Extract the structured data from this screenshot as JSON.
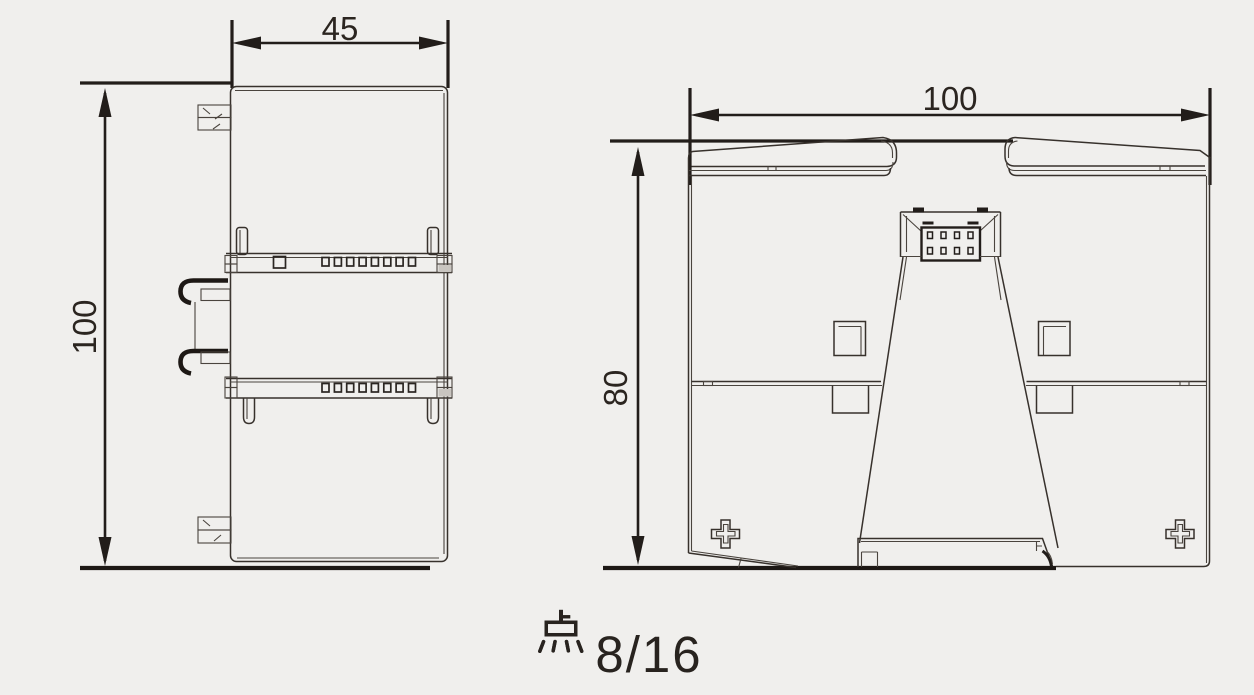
{
  "caption": "8点/16点",
  "side_view": {
    "label": "module side view",
    "width_dim": "45",
    "height_dim": "100"
  },
  "rear_view": {
    "label": "module rear view",
    "width_dim": "100",
    "height_dim": "80"
  },
  "colors": {
    "background": "#f0efed",
    "line": "#37312c",
    "dimension": "#221d1a"
  }
}
